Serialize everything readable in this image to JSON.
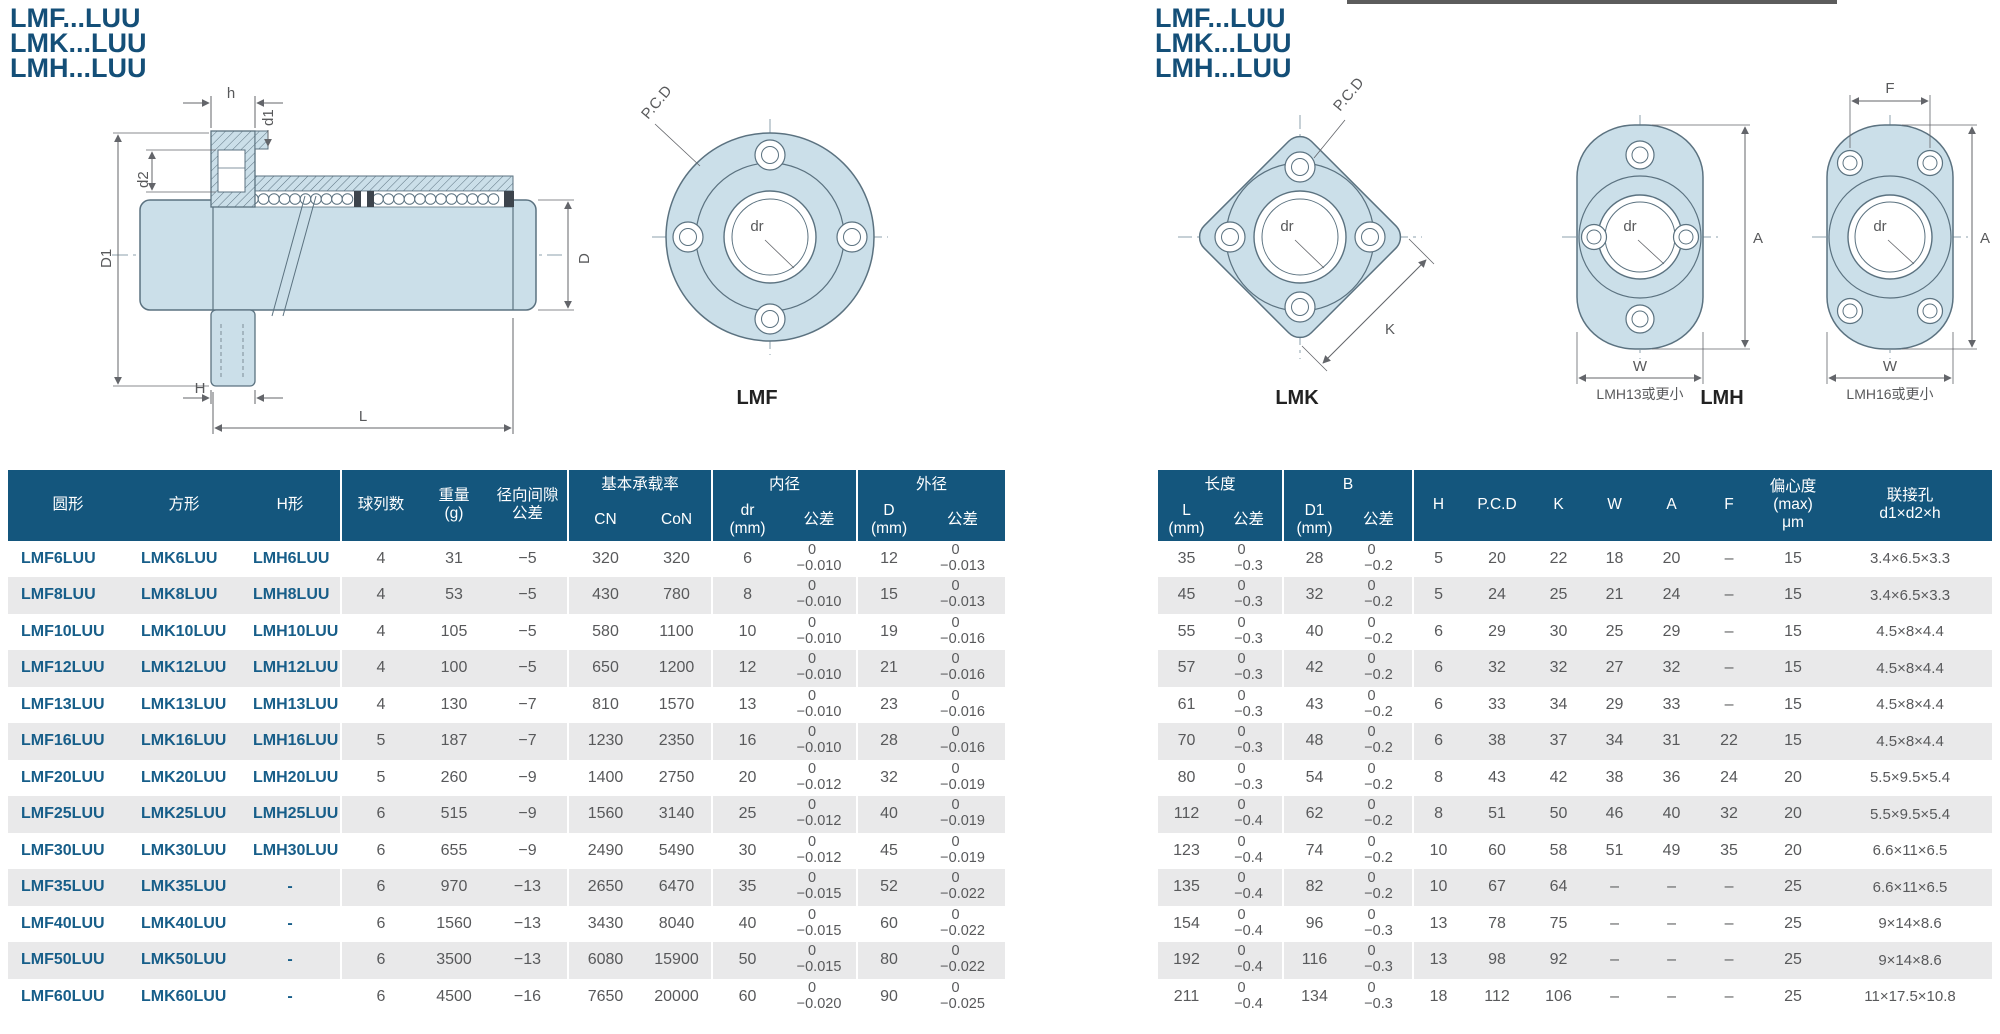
{
  "titles": {
    "line1": "LMF...LUU",
    "line2": "LMK...LUU",
    "line3": "LMH...LUU"
  },
  "colors": {
    "header_bg": "#14567d",
    "row_alt": "#e9e9ea",
    "model_text": "#175e89",
    "body_text": "#58595b",
    "title": "#144f78",
    "draw_fill": "#cbdfe9",
    "draw_stroke": "#5b7280",
    "dim": "#63656a"
  },
  "drawings": {
    "dim_h": "h",
    "dim_d1": "d1",
    "dim_d2": "d2",
    "dim_D1": "D1",
    "dim_D": "D",
    "dim_H": "H",
    "dim_L": "L",
    "pcd": "P.C.D",
    "dr": "dr",
    "dim_K": "K",
    "dim_A": "A",
    "dim_W": "W",
    "dim_F": "F",
    "lmf_caption": "LMF",
    "lmk_caption": "LMK",
    "lmh_caption": "LMH",
    "lmh13_caption": "LMH13或更小",
    "lmh16_caption": "LMH16或更小"
  },
  "left_table": {
    "headers": {
      "round": "圆形",
      "square": "方形",
      "h_type": "H形",
      "ball_rows": "球列数",
      "weight": "重量\n(g)",
      "clearance": "径向间隙\n公差",
      "load_group": "基本承载率",
      "cn": "CN",
      "con": "CoN",
      "bore_group": "内径",
      "dr": "dr\n(mm)",
      "tol": "公差",
      "od_group": "外径",
      "d": "D\n(mm)",
      "tol2": "公差"
    },
    "rows": [
      [
        "LMF6LUU",
        "LMK6LUU",
        "LMH6LUU",
        "4",
        "31",
        "−5",
        "320",
        "320",
        "6",
        "0\n−0.010",
        "12",
        "0\n−0.013"
      ],
      [
        "LMF8LUU",
        "LMK8LUU",
        "LMH8LUU",
        "4",
        "53",
        "−5",
        "430",
        "780",
        "8",
        "0\n−0.010",
        "15",
        "0\n−0.013"
      ],
      [
        "LMF10LUU",
        "LMK10LUU",
        "LMH10LUU",
        "4",
        "105",
        "−5",
        "580",
        "1100",
        "10",
        "0\n−0.010",
        "19",
        "0\n−0.016"
      ],
      [
        "LMF12LUU",
        "LMK12LUU",
        "LMH12LUU",
        "4",
        "100",
        "−5",
        "650",
        "1200",
        "12",
        "0\n−0.010",
        "21",
        "0\n−0.016"
      ],
      [
        "LMF13LUU",
        "LMK13LUU",
        "LMH13LUU",
        "4",
        "130",
        "−7",
        "810",
        "1570",
        "13",
        "0\n−0.010",
        "23",
        "0\n−0.016"
      ],
      [
        "LMF16LUU",
        "LMK16LUU",
        "LMH16LUU",
        "5",
        "187",
        "−7",
        "1230",
        "2350",
        "16",
        "0\n−0.010",
        "28",
        "0\n−0.016"
      ],
      [
        "LMF20LUU",
        "LMK20LUU",
        "LMH20LUU",
        "5",
        "260",
        "−9",
        "1400",
        "2750",
        "20",
        "0\n−0.012",
        "32",
        "0\n−0.019"
      ],
      [
        "LMF25LUU",
        "LMK25LUU",
        "LMH25LUU",
        "6",
        "515",
        "−9",
        "1560",
        "3140",
        "25",
        "0\n−0.012",
        "40",
        "0\n−0.019"
      ],
      [
        "LMF30LUU",
        "LMK30LUU",
        "LMH30LUU",
        "6",
        "655",
        "−9",
        "2490",
        "5490",
        "30",
        "0\n−0.012",
        "45",
        "0\n−0.019"
      ],
      [
        "LMF35LUU",
        "LMK35LUU",
        "-",
        "6",
        "970",
        "−13",
        "2650",
        "6470",
        "35",
        "0\n−0.015",
        "52",
        "0\n−0.022"
      ],
      [
        "LMF40LUU",
        "LMK40LUU",
        "-",
        "6",
        "1560",
        "−13",
        "3430",
        "8040",
        "40",
        "0\n−0.015",
        "60",
        "0\n−0.022"
      ],
      [
        "LMF50LUU",
        "LMK50LUU",
        "-",
        "6",
        "3500",
        "−13",
        "6080",
        "15900",
        "50",
        "0\n−0.015",
        "80",
        "0\n−0.022"
      ],
      [
        "LMF60LUU",
        "LMK60LUU",
        "-",
        "6",
        "4500",
        "−16",
        "7650",
        "20000",
        "60",
        "0\n−0.020",
        "90",
        "0\n−0.025"
      ]
    ]
  },
  "right_table": {
    "headers": {
      "length_group": "长度",
      "l": "L\n(mm)",
      "tol": "公差",
      "b_group": "B",
      "d1": "D1\n(mm)",
      "tol2": "公差",
      "h": "H",
      "pcd": "P.C.D",
      "k": "K",
      "w": "W",
      "a": "A",
      "f": "F",
      "ecc": "偏心度\n(max)\nμm",
      "hole": "联接孔\nd1×d2×h"
    },
    "rows": [
      [
        "35",
        "0\n−0.3",
        "28",
        "0\n−0.2",
        "5",
        "20",
        "22",
        "18",
        "20",
        "–",
        "15",
        "3.4×6.5×3.3"
      ],
      [
        "45",
        "0\n−0.3",
        "32",
        "0\n−0.2",
        "5",
        "24",
        "25",
        "21",
        "24",
        "–",
        "15",
        "3.4×6.5×3.3"
      ],
      [
        "55",
        "0\n−0.3",
        "40",
        "0\n−0.2",
        "6",
        "29",
        "30",
        "25",
        "29",
        "–",
        "15",
        "4.5×8×4.4"
      ],
      [
        "57",
        "0\n−0.3",
        "42",
        "0\n−0.2",
        "6",
        "32",
        "32",
        "27",
        "32",
        "–",
        "15",
        "4.5×8×4.4"
      ],
      [
        "61",
        "0\n−0.3",
        "43",
        "0\n−0.2",
        "6",
        "33",
        "34",
        "29",
        "33",
        "–",
        "15",
        "4.5×8×4.4"
      ],
      [
        "70",
        "0\n−0.3",
        "48",
        "0\n−0.2",
        "6",
        "38",
        "37",
        "34",
        "31",
        "22",
        "15",
        "4.5×8×4.4"
      ],
      [
        "80",
        "0\n−0.3",
        "54",
        "0\n−0.2",
        "8",
        "43",
        "42",
        "38",
        "36",
        "24",
        "20",
        "5.5×9.5×5.4"
      ],
      [
        "112",
        "0\n−0.4",
        "62",
        "0\n−0.2",
        "8",
        "51",
        "50",
        "46",
        "40",
        "32",
        "20",
        "5.5×9.5×5.4"
      ],
      [
        "123",
        "0\n−0.4",
        "74",
        "0\n−0.2",
        "10",
        "60",
        "58",
        "51",
        "49",
        "35",
        "20",
        "6.6×11×6.5"
      ],
      [
        "135",
        "0\n−0.4",
        "82",
        "0\n−0.2",
        "10",
        "67",
        "64",
        "–",
        "–",
        "–",
        "25",
        "6.6×11×6.5"
      ],
      [
        "154",
        "0\n−0.4",
        "96",
        "0\n−0.3",
        "13",
        "78",
        "75",
        "–",
        "–",
        "–",
        "25",
        "9×14×8.6"
      ],
      [
        "192",
        "0\n−0.4",
        "116",
        "0\n−0.3",
        "13",
        "98",
        "92",
        "–",
        "–",
        "–",
        "25",
        "9×14×8.6"
      ],
      [
        "211",
        "0\n−0.4",
        "134",
        "0\n−0.3",
        "18",
        "112",
        "106",
        "–",
        "–",
        "–",
        "25",
        "11×17.5×10.8"
      ]
    ]
  }
}
